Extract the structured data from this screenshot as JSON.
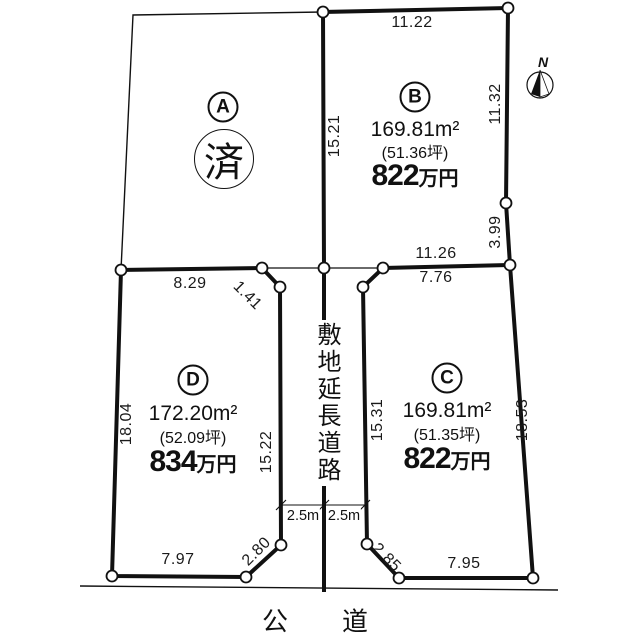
{
  "compass": {
    "label": "N"
  },
  "roads": {
    "bottom_road_label": "公　道",
    "center_road_label": "敷地延長道路",
    "center_road_width_left": "2.5m",
    "center_road_width_right": "2.5m"
  },
  "plots": [
    {
      "id": "A",
      "label": "A",
      "status": "済"
    },
    {
      "id": "B",
      "label": "B",
      "area": "169.81m²",
      "tsubo": "(51.36坪)",
      "price": "822",
      "price_unit": "万円"
    },
    {
      "id": "C",
      "label": "C",
      "area": "169.81m²",
      "tsubo": "(51.35坪)",
      "price": "822",
      "price_unit": "万円"
    },
    {
      "id": "D",
      "label": "D",
      "area": "172.20m²",
      "tsubo": "(52.09坪)",
      "price": "834",
      "price_unit": "万円"
    }
  ],
  "dimensions": {
    "b_top": "11.22",
    "ab_boundary": "15.21",
    "b_right_upper": "11.32",
    "b_right_lower": "3.99",
    "b_bottom": "11.26",
    "c_top": "7.76",
    "c_left": "15.31",
    "c_right": "18.53",
    "c_corner_bottom": "2.85",
    "c_bottom": "7.95",
    "d_top": "8.29",
    "d_corner_top": "1.41",
    "d_left": "18.04",
    "d_right": "15.22",
    "d_corner_bottom": "2.80",
    "d_bottom": "7.97"
  }
}
